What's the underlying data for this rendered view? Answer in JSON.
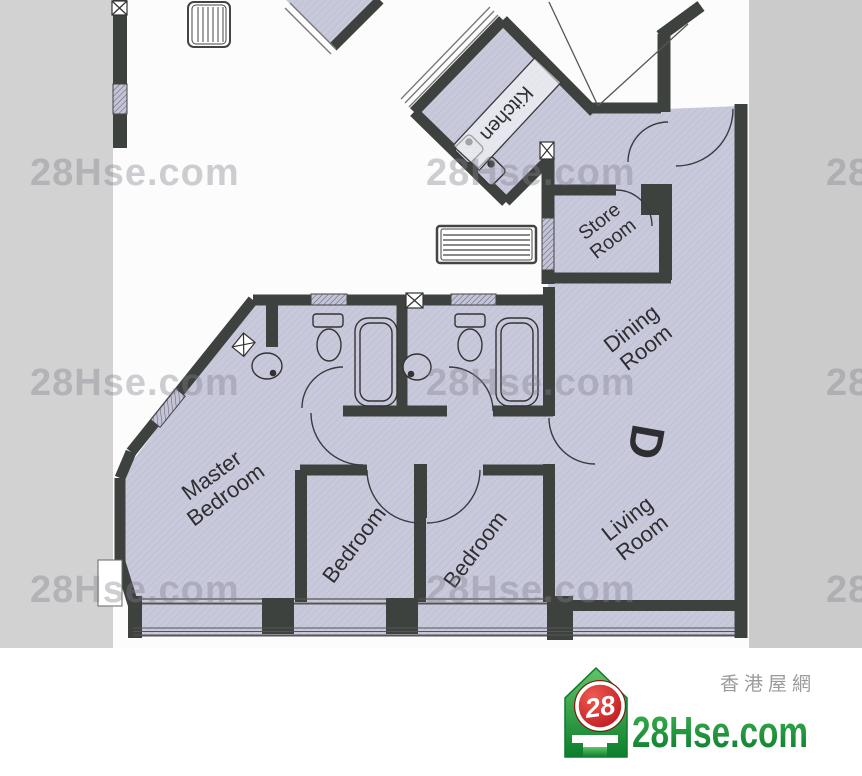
{
  "watermark": {
    "text": "28Hse.com"
  },
  "plan": {
    "labels": {
      "kitchen": "Kitchen",
      "store": {
        "l1": "Store",
        "l2": "Room"
      },
      "dining": {
        "l1": "Dining",
        "l2": "Room"
      },
      "unit": "D",
      "living": {
        "l1": "Living",
        "l2": "Room"
      },
      "master": {
        "l1": "Master",
        "l2": "Bedroom"
      },
      "bedroom1": "Bedroom",
      "bedroom2": "Bedroom"
    },
    "colors": {
      "floor": "#c9c9dc",
      "wall": "#3e423f",
      "side_gray": "#d2d2d2"
    }
  },
  "info_bar": {
    "bg": "#1e5c38",
    "title": "擎天半島 / Sorrento",
    "address": "柯士甸道1號",
    "tower": "6座　TOWER 6",
    "area": "998sqf(建築面積 Gross Area), 755 sqf(實用面積 Saleable Area)"
  },
  "logo": {
    "badge": "28",
    "site": "28Hse.com",
    "site_cn": "香港屋網",
    "green": "#119638",
    "red": "#cf1c24"
  }
}
